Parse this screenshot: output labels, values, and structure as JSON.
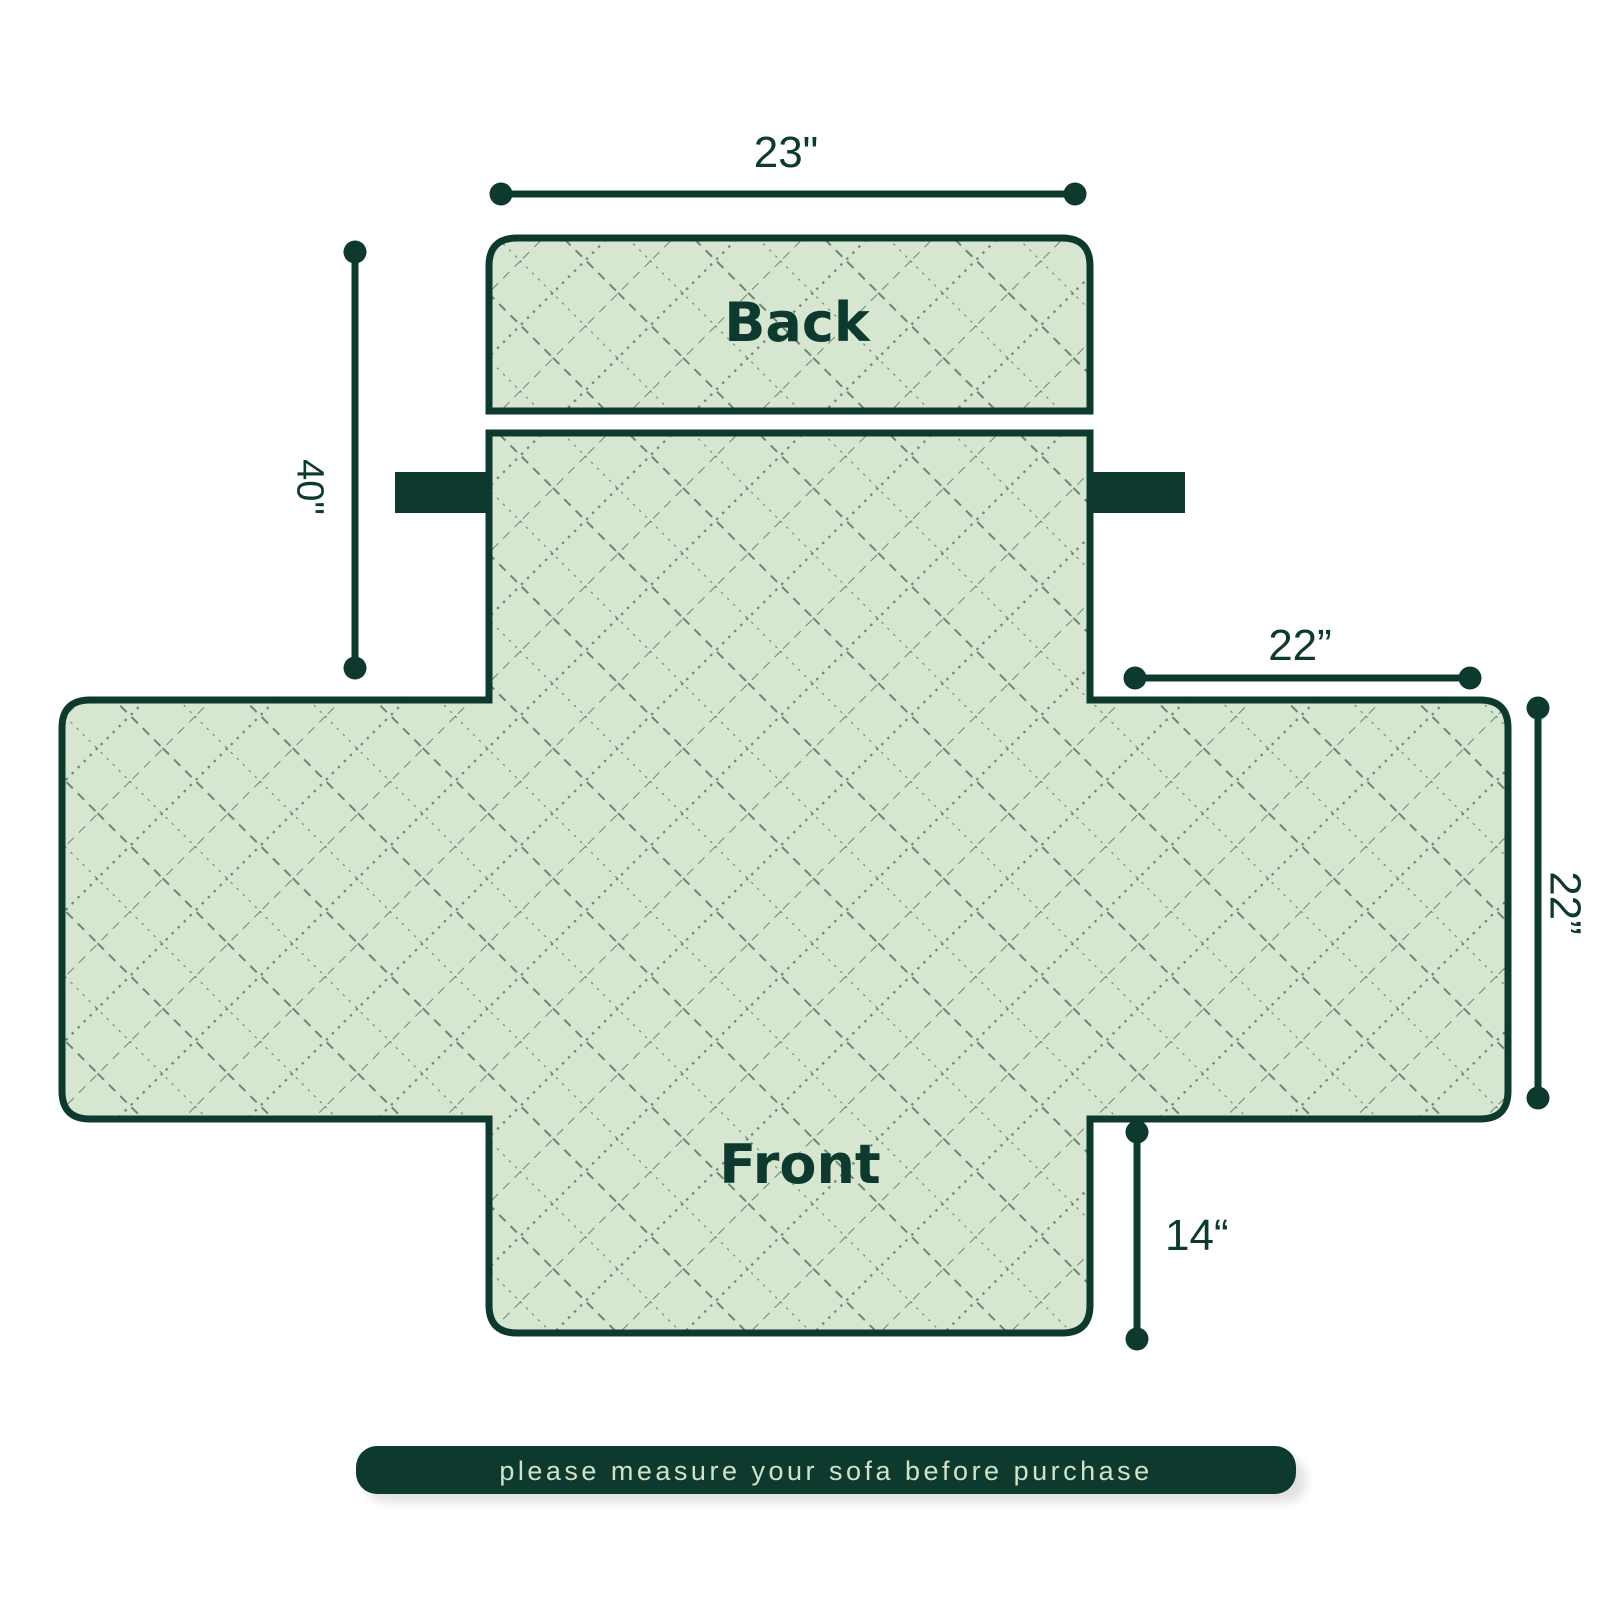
{
  "diagram": {
    "back_label": "Back",
    "front_label": "Front",
    "dimensions": {
      "back_width": "23\"",
      "side_height": "40\"",
      "arm_width": "22”",
      "arm_depth": "22”",
      "front_drop": "14“"
    },
    "banner": {
      "label": "please measure your sofa before purchase"
    }
  },
  "colors": {
    "outline_dark_green": "#0d392e",
    "cover_light_green": "#d7e6d1",
    "quilt_stitch_green": "#466852",
    "banner_background": "#0d392e",
    "banner_text_green": "#cfe3c9",
    "page_background": "#ffffff"
  }
}
